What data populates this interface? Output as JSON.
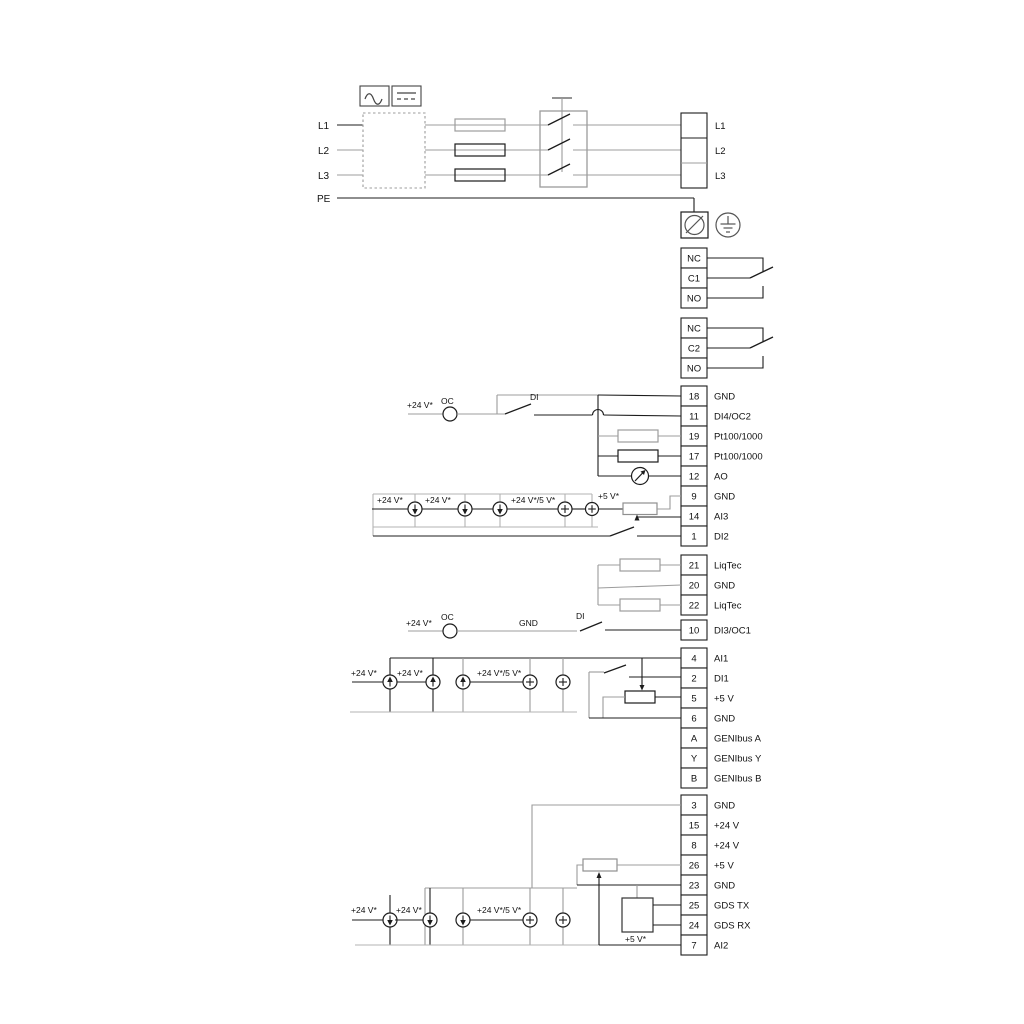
{
  "power": {
    "left": [
      "L1",
      "L2",
      "L3",
      "PE"
    ],
    "right": [
      "L1",
      "L2",
      "L3"
    ]
  },
  "relay1": [
    "NC",
    "C1",
    "NO"
  ],
  "relay2": [
    "NC",
    "C2",
    "NO"
  ],
  "io_a": [
    {
      "num": "18",
      "label": "GND"
    },
    {
      "num": "11",
      "label": "DI4/OC2"
    },
    {
      "num": "19",
      "label": "Pt100/1000"
    },
    {
      "num": "17",
      "label": "Pt100/1000"
    },
    {
      "num": "12",
      "label": "AO"
    },
    {
      "num": "9",
      "label": "GND"
    },
    {
      "num": "14",
      "label": "AI3"
    },
    {
      "num": "1",
      "label": "DI2"
    }
  ],
  "liqtec": [
    {
      "num": "21",
      "label": "LiqTec"
    },
    {
      "num": "20",
      "label": "GND"
    },
    {
      "num": "22",
      "label": "LiqTec"
    }
  ],
  "io_b": [
    {
      "num": "10",
      "label": "DI3/OC1"
    },
    {
      "num": "4",
      "label": "AI1"
    },
    {
      "num": "2",
      "label": "DI1"
    },
    {
      "num": "5",
      "label": "+5 V"
    },
    {
      "num": "6",
      "label": "GND"
    },
    {
      "num": "A",
      "label": "GENIbus A"
    },
    {
      "num": "Y",
      "label": "GENIbus Y"
    },
    {
      "num": "B",
      "label": "GENIbus B"
    }
  ],
  "io_c": [
    {
      "num": "3",
      "label": "GND"
    },
    {
      "num": "15",
      "label": "+24 V"
    },
    {
      "num": "8",
      "label": "+24 V"
    },
    {
      "num": "26",
      "label": "+5 V"
    },
    {
      "num": "23",
      "label": "GND"
    },
    {
      "num": "25",
      "label": "GDS TX"
    },
    {
      "num": "24",
      "label": "GDS RX"
    },
    {
      "num": "7",
      "label": "AI2"
    }
  ],
  "ann": {
    "v24": "+24 V*",
    "v24_5": "+24 V*/5 V*",
    "v5": "+5 V*",
    "oc": "OC",
    "di": "DI",
    "gnd": "GND"
  }
}
